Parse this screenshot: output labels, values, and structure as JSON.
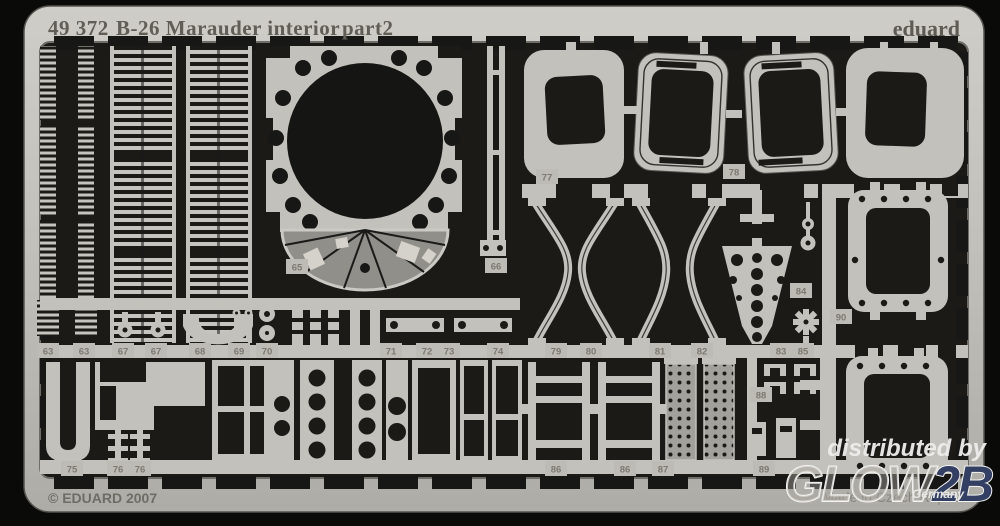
{
  "header": {
    "code": "49 372",
    "title": "B-26 Marauder interior",
    "part": "part2",
    "brand": "eduard"
  },
  "footer": {
    "copyright": "© EDUARD 2007",
    "made_in": "Made in Czech Republic"
  },
  "watermark": {
    "prefix": "distributed by",
    "logo_main": "GLOW",
    "logo_suffix": "2B",
    "country": "Germany"
  },
  "colors": {
    "frame_light": "#c9c7c1",
    "frame_dark": "#aeaca6",
    "metal": "#c3c1bb",
    "background": "#1b1a17",
    "panel_gray": "#908f89",
    "number_text": "#7b7971",
    "logo_blue": "#344063",
    "watermark_white": "#eeeeec"
  },
  "part_labels": [
    {
      "t": "63",
      "x": 48,
      "y": 351
    },
    {
      "t": "63",
      "x": 84,
      "y": 351
    },
    {
      "t": "67",
      "x": 123,
      "y": 351
    },
    {
      "t": "67",
      "x": 156,
      "y": 351
    },
    {
      "t": "68",
      "x": 200,
      "y": 351
    },
    {
      "t": "69",
      "x": 239,
      "y": 351
    },
    {
      "t": "70",
      "x": 267,
      "y": 351
    },
    {
      "t": "65",
      "x": 297,
      "y": 267
    },
    {
      "t": "66",
      "x": 496,
      "y": 266
    },
    {
      "t": "71",
      "x": 391,
      "y": 351
    },
    {
      "t": "72",
      "x": 427,
      "y": 351
    },
    {
      "t": "73",
      "x": 449,
      "y": 351
    },
    {
      "t": "74",
      "x": 498,
      "y": 351
    },
    {
      "t": "77",
      "x": 547,
      "y": 177
    },
    {
      "t": "78",
      "x": 734,
      "y": 172
    },
    {
      "t": "79",
      "x": 556,
      "y": 351
    },
    {
      "t": "80",
      "x": 591,
      "y": 351
    },
    {
      "t": "81",
      "x": 660,
      "y": 351
    },
    {
      "t": "82",
      "x": 702,
      "y": 351
    },
    {
      "t": "83",
      "x": 781,
      "y": 351
    },
    {
      "t": "84",
      "x": 801,
      "y": 291
    },
    {
      "t": "85",
      "x": 803,
      "y": 351
    },
    {
      "t": "90",
      "x": 841,
      "y": 317
    },
    {
      "t": "75",
      "x": 72,
      "y": 469
    },
    {
      "t": "76",
      "x": 118,
      "y": 469
    },
    {
      "t": "76",
      "x": 140,
      "y": 469
    },
    {
      "t": "86",
      "x": 556,
      "y": 469
    },
    {
      "t": "86",
      "x": 625,
      "y": 469
    },
    {
      "t": "87",
      "x": 663,
      "y": 469
    },
    {
      "t": "88",
      "x": 761,
      "y": 395
    },
    {
      "t": "89",
      "x": 764,
      "y": 469
    }
  ]
}
